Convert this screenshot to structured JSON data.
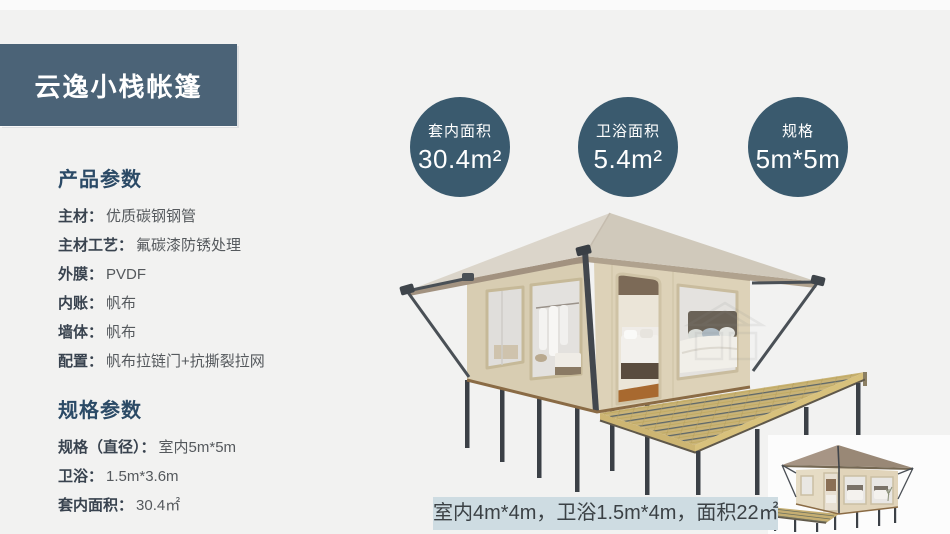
{
  "banner": {
    "title": "云逸小栈帐篷"
  },
  "product_params": {
    "heading": "产品参数",
    "rows": [
      {
        "label": "主材：",
        "value": "优质碳钢钢管"
      },
      {
        "label": "主材工艺：",
        "value": "氟碳漆防锈处理"
      },
      {
        "label": "外膜：",
        "value": "PVDF"
      },
      {
        "label": "内账：",
        "value": "帆布"
      },
      {
        "label": "墙体：",
        "value": "帆布"
      },
      {
        "label": "配置：",
        "value": "帆布拉链门+抗撕裂拉网"
      }
    ]
  },
  "spec_params": {
    "heading": "规格参数",
    "rows": [
      {
        "label": "规格（直径）：",
        "value": "室内5m*5m"
      },
      {
        "label": "卫浴：",
        "value": "1.5m*3.6m"
      },
      {
        "label": "套内面积：",
        "value": "30.4㎡"
      }
    ]
  },
  "stat_circles": [
    {
      "label": "套内面积",
      "value": "30.4m²"
    },
    {
      "label": "卫浴面积",
      "value": "5.4m²"
    },
    {
      "label": "规格",
      "value": "5m*5m"
    }
  ],
  "caption": {
    "text": "室内4m*4m，卫浴1.5m*4m，面积22㎡"
  },
  "colors": {
    "page_bg": "#f2f2f1",
    "banner_bg": "#4b6377",
    "circle_bg": "#3a5a6e",
    "caption_bg": "#cedce2",
    "heading_text": "#2b4a66",
    "tent_canvas": "#d8cdb2",
    "tent_roof": "#d6cfc4",
    "deck_wood": "#c9b377"
  }
}
